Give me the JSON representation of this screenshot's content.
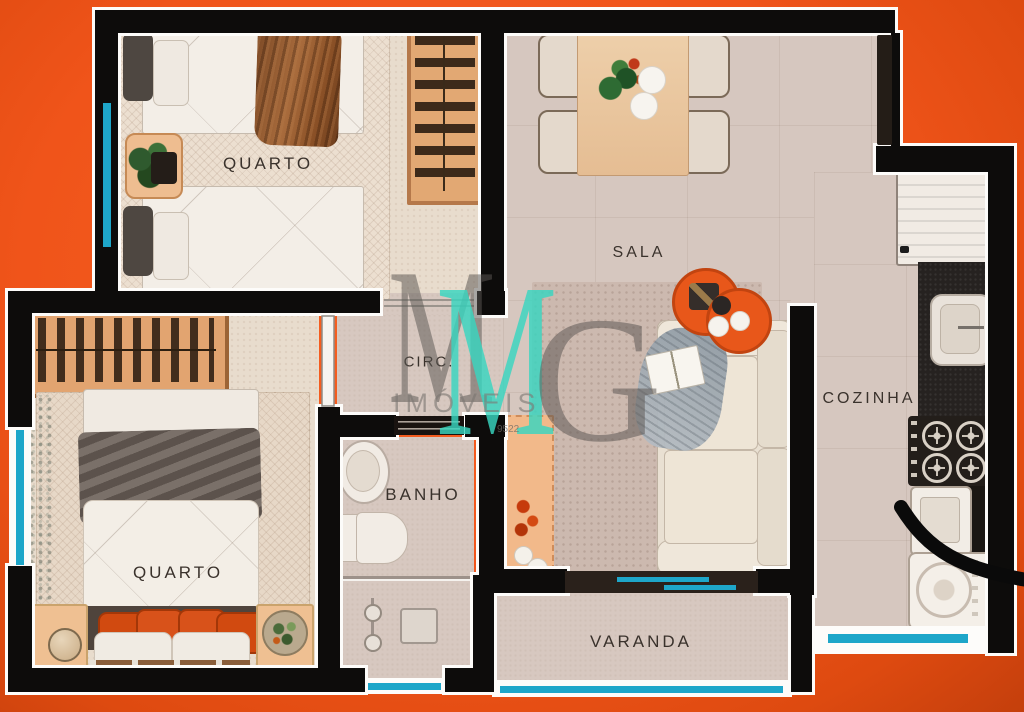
{
  "app": {
    "type": "real-estate floor plan rendering",
    "view": "top-down apartment plan on orange backdrop"
  },
  "rooms": {
    "quarto1": {
      "label": "QUARTO"
    },
    "sala": {
      "label": "SALA"
    },
    "cozinha": {
      "label": "COZINHA"
    },
    "circulacao": {
      "label": "CIRC."
    },
    "banho": {
      "label": "BANHO"
    },
    "quarto2": {
      "label": "QUARTO"
    },
    "varanda": {
      "label": "VARANDA"
    }
  },
  "watermark": {
    "monogram_m_gray": "M",
    "monogram_m_teal": "M",
    "monogram_g": "G",
    "brand": "IMÓVEIS",
    "phone_fragment": "9522"
  },
  "palette": {
    "background_orange": "#f0541a",
    "wall_black": "#0d0c0b",
    "outline_white": "#fdfcfa",
    "window_cyan": "#1ea6c9",
    "watermark_teal": "#38d6c0",
    "watermark_gray": "#5a5652",
    "accent_furniture_orange": "#e2561a",
    "floor_beige": "#d7c8c0"
  },
  "furniture_icons": {
    "quarto1": [
      "single-bed",
      "single-bed",
      "nightstand-plant",
      "wardrobe-hangers",
      "area-rug"
    ],
    "sala": [
      "dining-table",
      "dining-chair-x4",
      "table-plant",
      "plates",
      "sofa",
      "throw-blanket",
      "book",
      "round-side-table-x2",
      "console-shelf",
      "dot-rug"
    ],
    "cozinha": [
      "refrigerator",
      "counter-sink",
      "stove-4-burners",
      "laundry-tank",
      "washing-machine"
    ],
    "banho": [
      "vanity-sink",
      "toilet",
      "shower-partition",
      "shower-head"
    ],
    "quarto2": [
      "double-bed",
      "orange-pillows",
      "wardrobe-hangers",
      "nightstand-lamp",
      "nightstand-plant",
      "window-curtain",
      "area-rug"
    ],
    "annotations": [
      "black-marker-curve",
      "cyan-window-lines"
    ]
  }
}
